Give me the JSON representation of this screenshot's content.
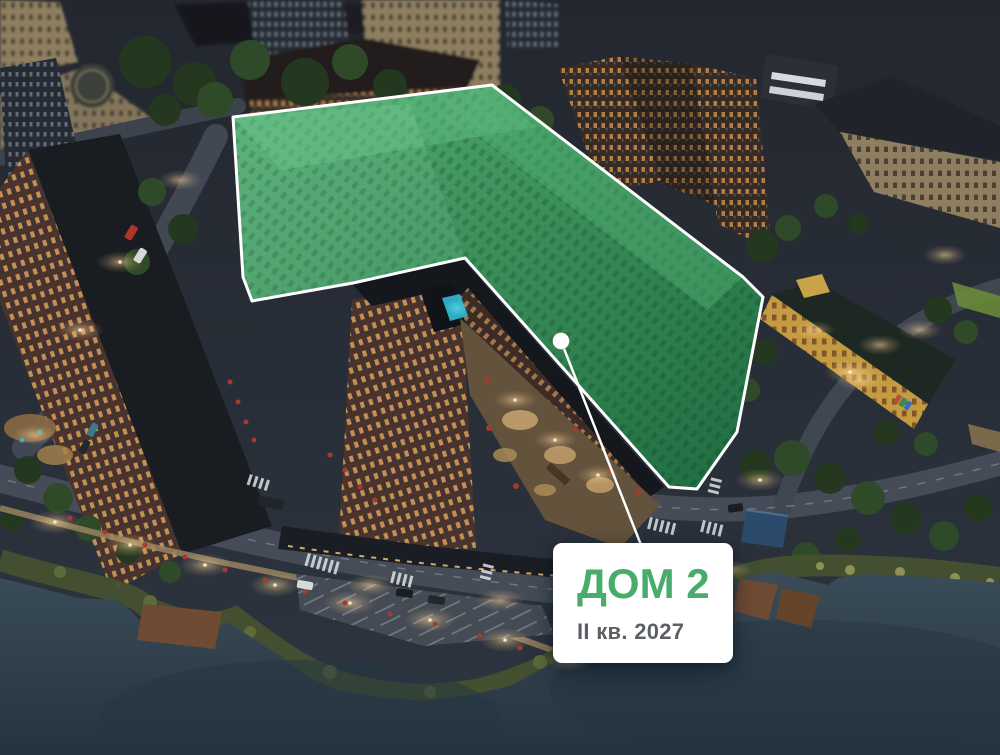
{
  "map": {
    "card": {
      "title": "ДОМ 2",
      "subtitle": "II кв. 2027"
    }
  },
  "colors": {
    "highlight_fill": "#3E9B60",
    "highlight_outline": "#FFFFFF",
    "marker_dot": "#FFFFFF",
    "card_background": "#FFFFFF",
    "card_title": "#48AC6C",
    "card_subtitle": "#5C6065"
  }
}
